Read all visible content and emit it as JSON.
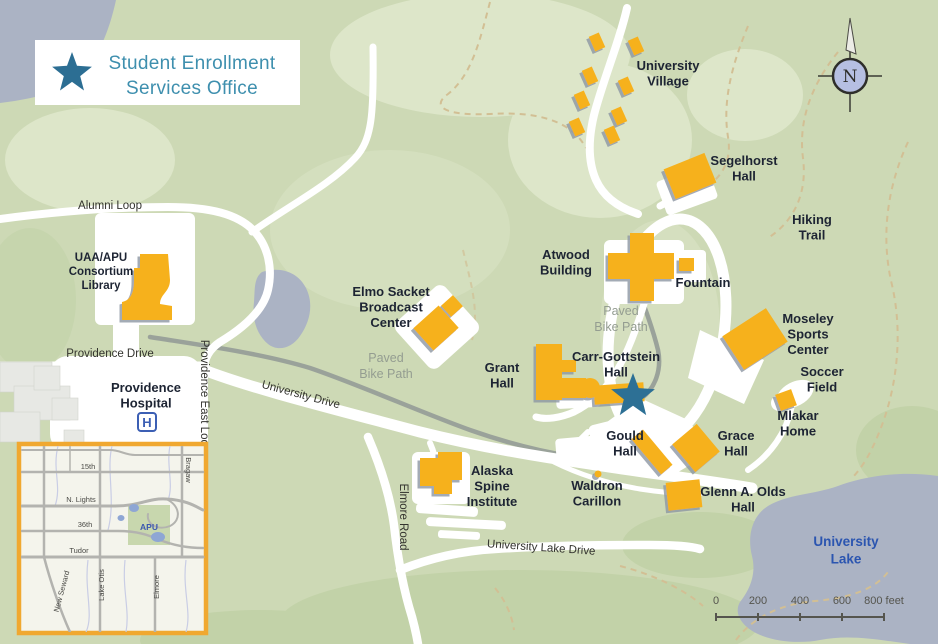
{
  "legend": {
    "line1": "Student Enrollment",
    "line2": "Services Office"
  },
  "compass": {
    "label": "N"
  },
  "hospital": {
    "icon_letter": "H"
  },
  "colors": {
    "base_green": "#cdd9b5",
    "light_green": "#dde6c9",
    "dark_green": "#c2d2a8",
    "water": "#abb3c4",
    "road": "#ffffff",
    "bike_path": "#9aa29a",
    "trail": "#d2bf94",
    "building": "#f6b11f",
    "building_shadow": "#8d95a3",
    "marker_star": "#2d7095",
    "legend_text": "#3e8fae",
    "lake_label": "#2b55b0",
    "inset_border": "#f0a830"
  },
  "map": {
    "labels": [
      {
        "id": "university-village",
        "lines": [
          "University",
          "Village"
        ],
        "x": 668,
        "y": 70,
        "cls": "bld"
      },
      {
        "id": "segelhorst-hall",
        "lines": [
          "Segelhorst",
          "Hall"
        ],
        "x": 744,
        "y": 165,
        "cls": "bld"
      },
      {
        "id": "hiking-trail",
        "lines": [
          "Hiking",
          "Trail"
        ],
        "x": 812,
        "y": 224,
        "cls": "bld"
      },
      {
        "id": "atwood-building",
        "lines": [
          "Atwood",
          "Building"
        ],
        "x": 566,
        "y": 259,
        "cls": "bld"
      },
      {
        "id": "fountain",
        "lines": [
          "Fountain"
        ],
        "x": 703,
        "y": 287,
        "cls": "bld"
      },
      {
        "id": "moseley-sports-center",
        "lines": [
          "Moseley",
          "Sports",
          "Center"
        ],
        "x": 808,
        "y": 323,
        "cls": "bld"
      },
      {
        "id": "soccer-field",
        "lines": [
          "Soccer",
          "Field"
        ],
        "x": 822,
        "y": 376,
        "cls": "bld"
      },
      {
        "id": "mlakar-home",
        "lines": [
          "Mlakar",
          "Home"
        ],
        "x": 798,
        "y": 420,
        "cls": "bld"
      },
      {
        "id": "carr-gottstein-hall",
        "lines": [
          "Carr-Gottstein",
          "Hall"
        ],
        "x": 616,
        "y": 361,
        "cls": "bld"
      },
      {
        "id": "grant-hall",
        "lines": [
          "Grant",
          "Hall"
        ],
        "x": 502,
        "y": 372,
        "cls": "bld"
      },
      {
        "id": "elmo-sacket-broadcast-center",
        "lines": [
          "Elmo Sacket",
          "Broadcast",
          "Center"
        ],
        "x": 391,
        "y": 296,
        "cls": "bld"
      },
      {
        "id": "uaa-apu-consortium-library",
        "lines": [
          "UAA/APU",
          "Consortium",
          "Library"
        ],
        "x": 101,
        "y": 261,
        "cls": "bld-s"
      },
      {
        "id": "gould-hall",
        "lines": [
          "Gould",
          "Hall"
        ],
        "x": 625,
        "y": 440,
        "cls": "bld"
      },
      {
        "id": "grace-hall",
        "lines": [
          "Grace",
          "Hall"
        ],
        "x": 736,
        "y": 440,
        "cls": "bld"
      },
      {
        "id": "waldron-carillon",
        "lines": [
          "Waldron",
          "Carillon"
        ],
        "x": 597,
        "y": 490,
        "cls": "bld"
      },
      {
        "id": "glenn-a-olds-hall",
        "lines": [
          "Glenn A. Olds",
          "Hall"
        ],
        "x": 743,
        "y": 496,
        "cls": "bld"
      },
      {
        "id": "alaska-spine-institute",
        "lines": [
          "Alaska",
          "Spine",
          "Institute"
        ],
        "x": 492,
        "y": 475,
        "cls": "bld"
      },
      {
        "id": "providence-hospital",
        "lines": [
          "Providence",
          "Hospital"
        ],
        "x": 146,
        "y": 392,
        "cls": "bld"
      },
      {
        "id": "alumni-loop",
        "lines": [
          "Alumni Loop"
        ],
        "x": 110,
        "y": 209,
        "cls": "road"
      },
      {
        "id": "providence-drive",
        "lines": [
          "Providence Drive"
        ],
        "x": 110,
        "y": 357,
        "cls": "road"
      },
      {
        "id": "providence-east-loop",
        "lines": [
          "Providence East Loop"
        ],
        "x": 201,
        "y": 396,
        "cls": "road",
        "rot": 90
      },
      {
        "id": "university-drive",
        "lines": [
          "University Drive"
        ],
        "x": 300,
        "y": 398,
        "cls": "road",
        "rot": 15
      },
      {
        "id": "elmore-road",
        "lines": [
          "Elmore Road"
        ],
        "x": 400,
        "y": 517,
        "cls": "road",
        "rot": 90
      },
      {
        "id": "university-lake-drive",
        "lines": [
          "University Lake Drive"
        ],
        "x": 541,
        "y": 551,
        "cls": "road",
        "rot": 4
      },
      {
        "id": "paved-bike-path-west",
        "lines": [
          "Paved",
          "Bike Path"
        ],
        "x": 386,
        "y": 362,
        "cls": "bike"
      },
      {
        "id": "paved-bike-path-east",
        "lines": [
          "Paved",
          "Bike Path"
        ],
        "x": 621,
        "y": 315,
        "cls": "bike"
      },
      {
        "id": "university-lake",
        "lines": [
          "University",
          "Lake"
        ],
        "x": 846,
        "y": 546,
        "cls": "lake"
      }
    ]
  },
  "scale_bar": {
    "ticks": [
      {
        "label": "0",
        "x": 716
      },
      {
        "label": "200",
        "x": 758
      },
      {
        "label": "400",
        "x": 800
      },
      {
        "label": "600",
        "x": 842
      },
      {
        "label": "800 feet",
        "x": 884
      }
    ],
    "label_y": 604,
    "line_y": 617,
    "x1": 716,
    "x2": 884
  },
  "inset": {
    "labels": [
      {
        "id": "15th",
        "text": "15th",
        "x": 88,
        "y": 469
      },
      {
        "id": "n-lights",
        "text": "N. Lights",
        "x": 81,
        "y": 502
      },
      {
        "id": "36th",
        "text": "36th",
        "x": 85,
        "y": 527
      },
      {
        "id": "tudor",
        "text": "Tudor",
        "x": 79,
        "y": 553
      },
      {
        "id": "apu",
        "text": "APU",
        "x": 149,
        "y": 530,
        "cls": "apu"
      },
      {
        "id": "bragaw",
        "text": "Bragaw",
        "x": 186,
        "y": 470,
        "rot": 90
      },
      {
        "id": "new-seward",
        "text": "New Seward",
        "x": 64,
        "y": 592,
        "rot": -75
      },
      {
        "id": "lake-otis",
        "text": "Lake Otis",
        "x": 104,
        "y": 585,
        "rot": -90
      },
      {
        "id": "elmore",
        "text": "Elmore",
        "x": 159,
        "y": 587,
        "rot": -90
      }
    ]
  }
}
